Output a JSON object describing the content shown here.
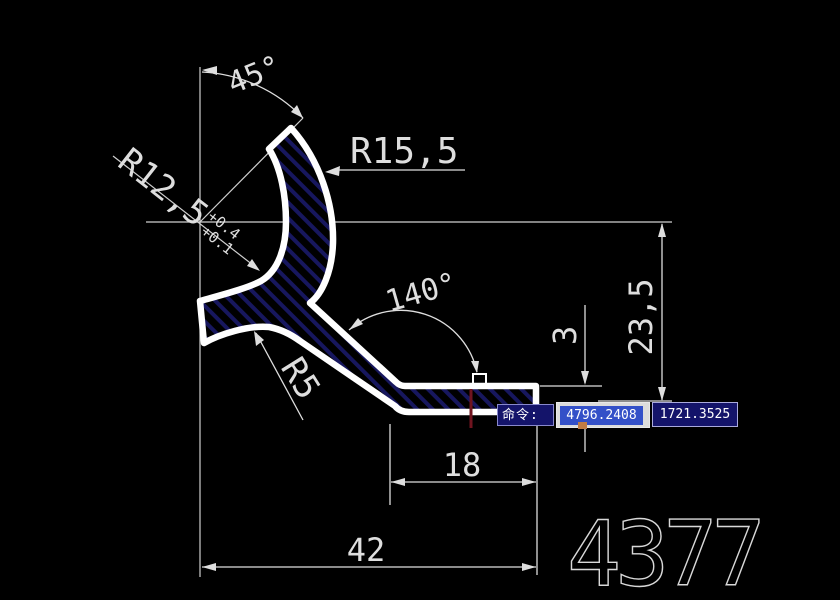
{
  "window": {
    "background": "#000000"
  },
  "drawing": {
    "colors": {
      "line": "#dedede",
      "profile_stroke": "#ffffff",
      "hatch_blue": "#17175e",
      "snap_marker_red": "#70141f",
      "autosnap_orange": "#c07c45",
      "selection_blue": "#3350c8",
      "command_box_navy": "#14146a"
    },
    "dimensions": {
      "angle_top": "45°",
      "radius_outer": "R15,5",
      "radius_inner": "R12,5",
      "radius_inner_tol_upper": "+0.4",
      "radius_inner_tol_lower": "+0.1",
      "angle_arm": "140°",
      "fillet_radius": "R5",
      "wall_thickness": "3",
      "height": "23,5",
      "length_inner": "18",
      "length_total": "42"
    },
    "part_number": "4377"
  },
  "command_bar": {
    "prompt_label": "命令:",
    "coord_x_value": "4796.2408",
    "coord_y_value": "1721.3525"
  }
}
